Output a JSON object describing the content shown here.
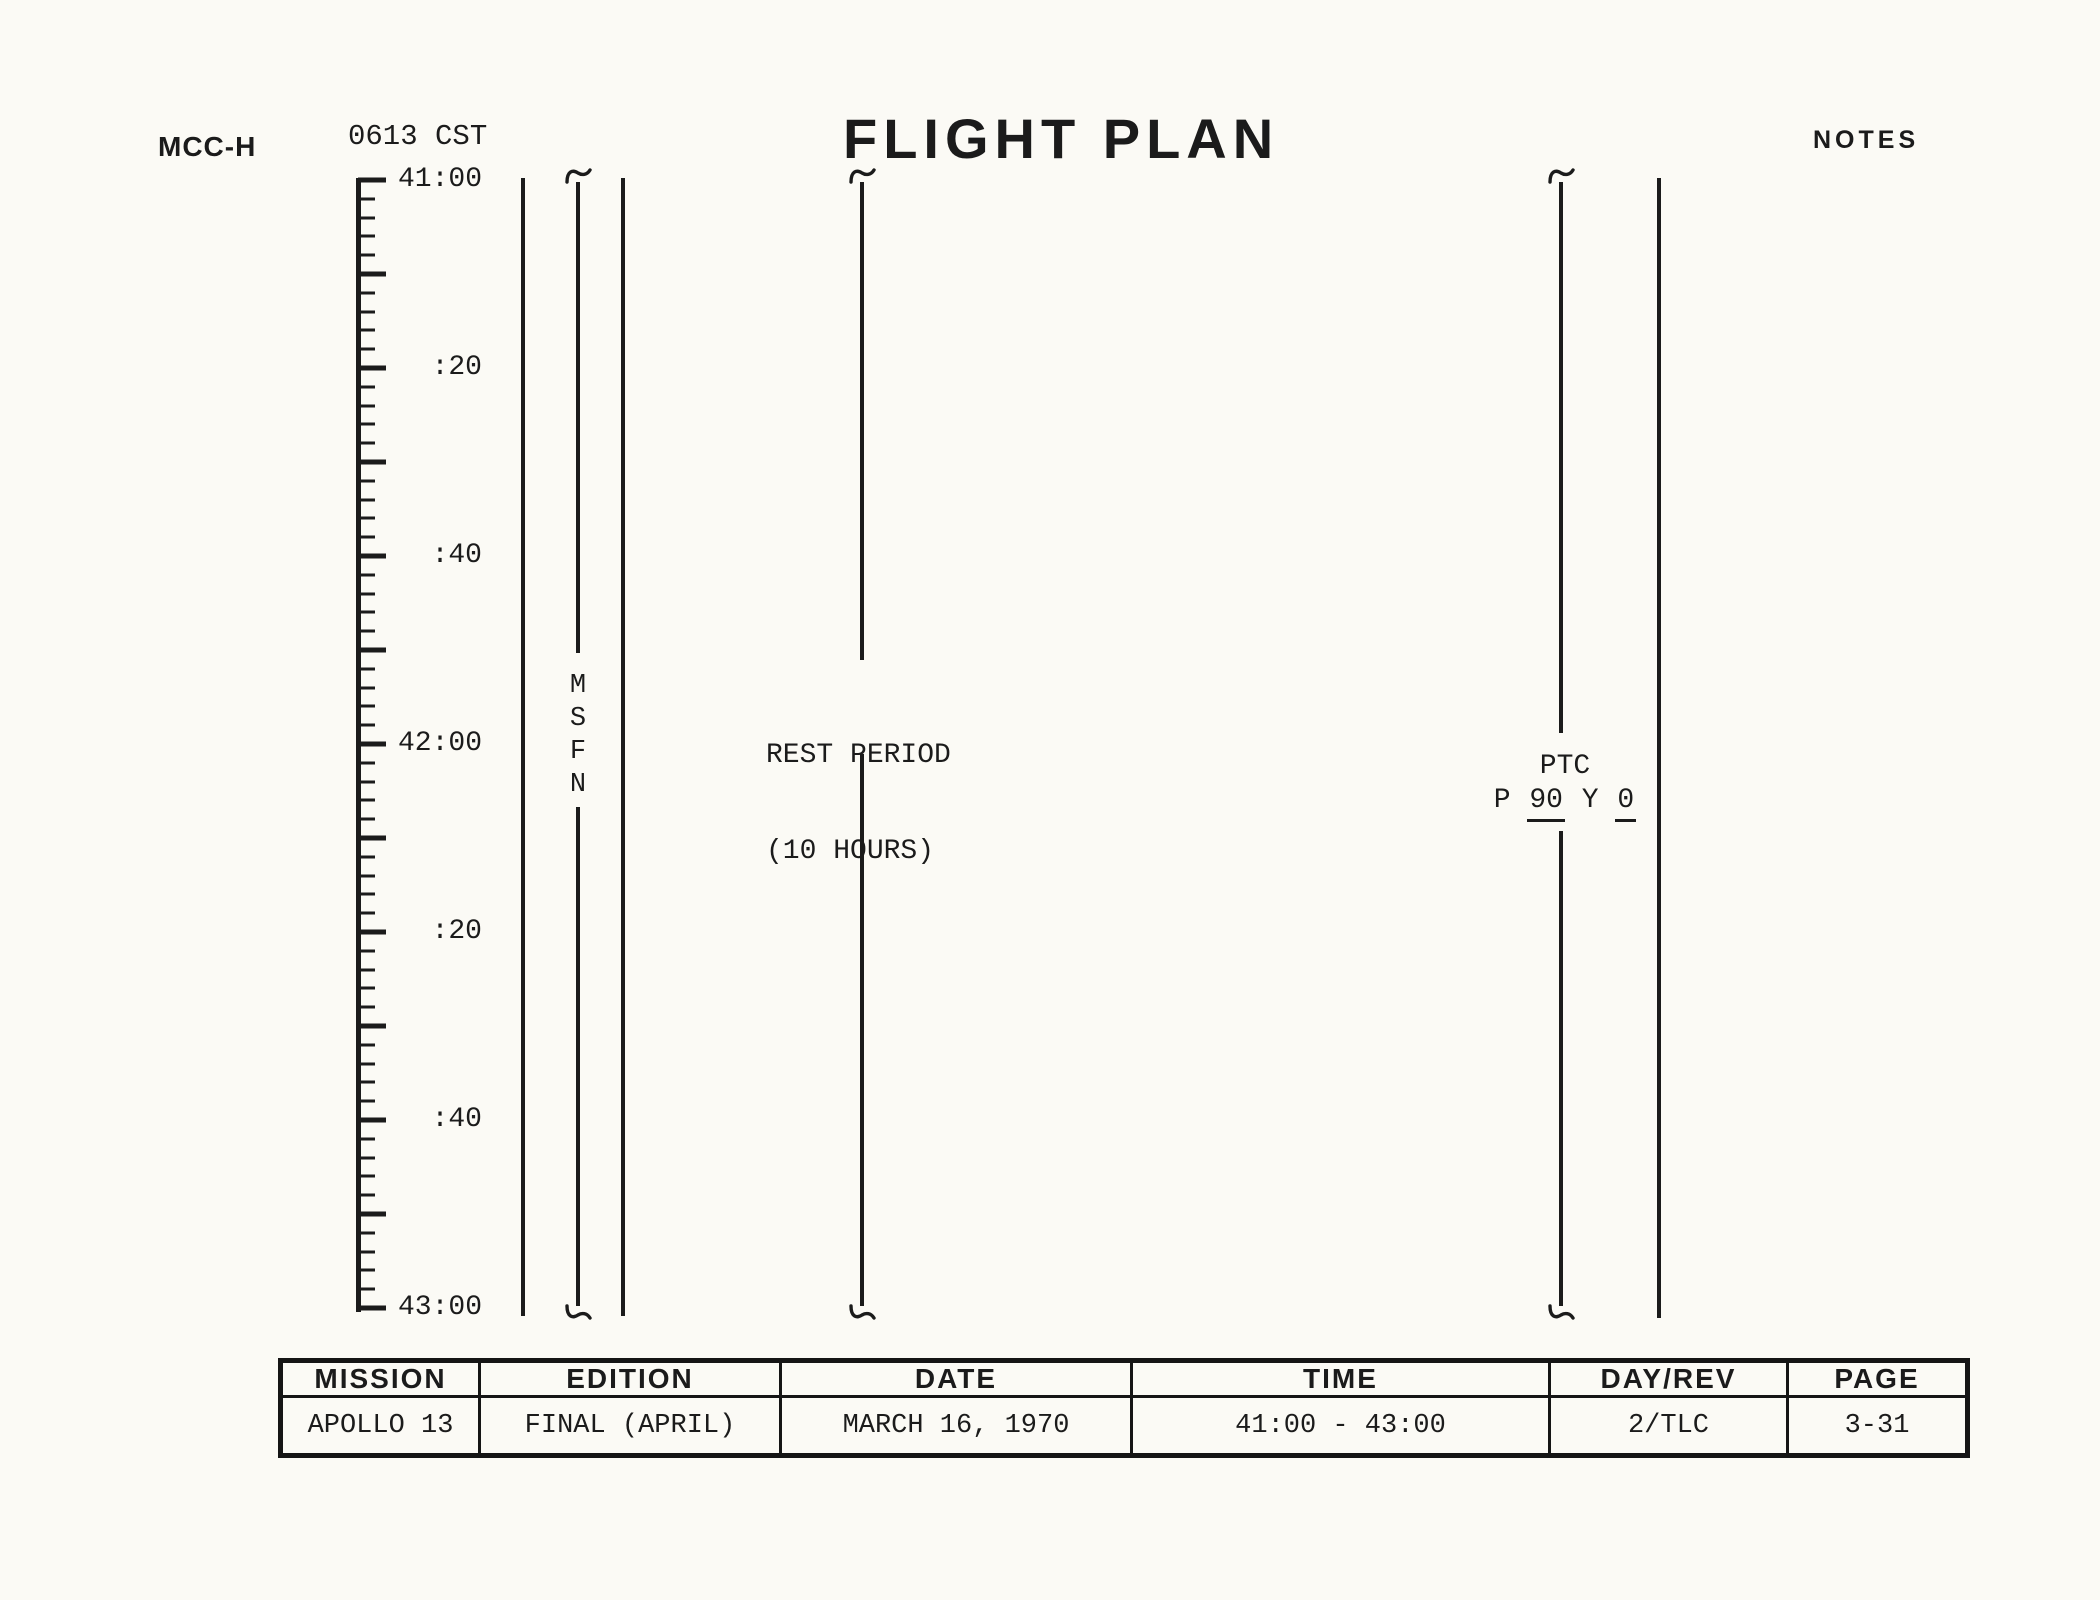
{
  "header": {
    "site": "MCC-H",
    "cst_time": "0613 CST",
    "title": "FLIGHT PLAN",
    "notes": "NOTES"
  },
  "timeline": {
    "start_label": "41:00",
    "end_label": "43:00",
    "total_minutes": 120,
    "tick_interval_minutes": 2,
    "major_tick_every_minutes": 10,
    "labels": [
      {
        "text": "41:00",
        "minutes": 0
      },
      {
        "text": ":20",
        "minutes": 20
      },
      {
        "text": ":40",
        "minutes": 40
      },
      {
        "text": "42:00",
        "minutes": 60
      },
      {
        "text": ":20",
        "minutes": 80
      },
      {
        "text": ":40",
        "minutes": 100
      },
      {
        "text": "43:00",
        "minutes": 120
      }
    ]
  },
  "bands": {
    "msfn": {
      "name": "MSFN coverage band",
      "letters": [
        "M",
        "S",
        "F",
        "N"
      ]
    },
    "rest": {
      "line1": "REST PERIOD",
      "line2": "(10 HOURS)"
    },
    "ptc": {
      "title": "PTC",
      "p_label": "P",
      "p_value": "90",
      "y_label": "Y",
      "y_value": "0"
    }
  },
  "footer_table": {
    "columns": [
      {
        "header": "MISSION",
        "value": "APOLLO 13"
      },
      {
        "header": "EDITION",
        "value": "FINAL (APRIL)"
      },
      {
        "header": "DATE",
        "value": "MARCH 16, 1970"
      },
      {
        "header": "TIME",
        "value": "41:00 - 43:00"
      },
      {
        "header": "DAY/REV",
        "value": "2/TLC"
      },
      {
        "header": "PAGE",
        "value": "3-31"
      }
    ]
  },
  "colors": {
    "ink": "#1b1b1b",
    "paper": "#fbfaf5"
  }
}
